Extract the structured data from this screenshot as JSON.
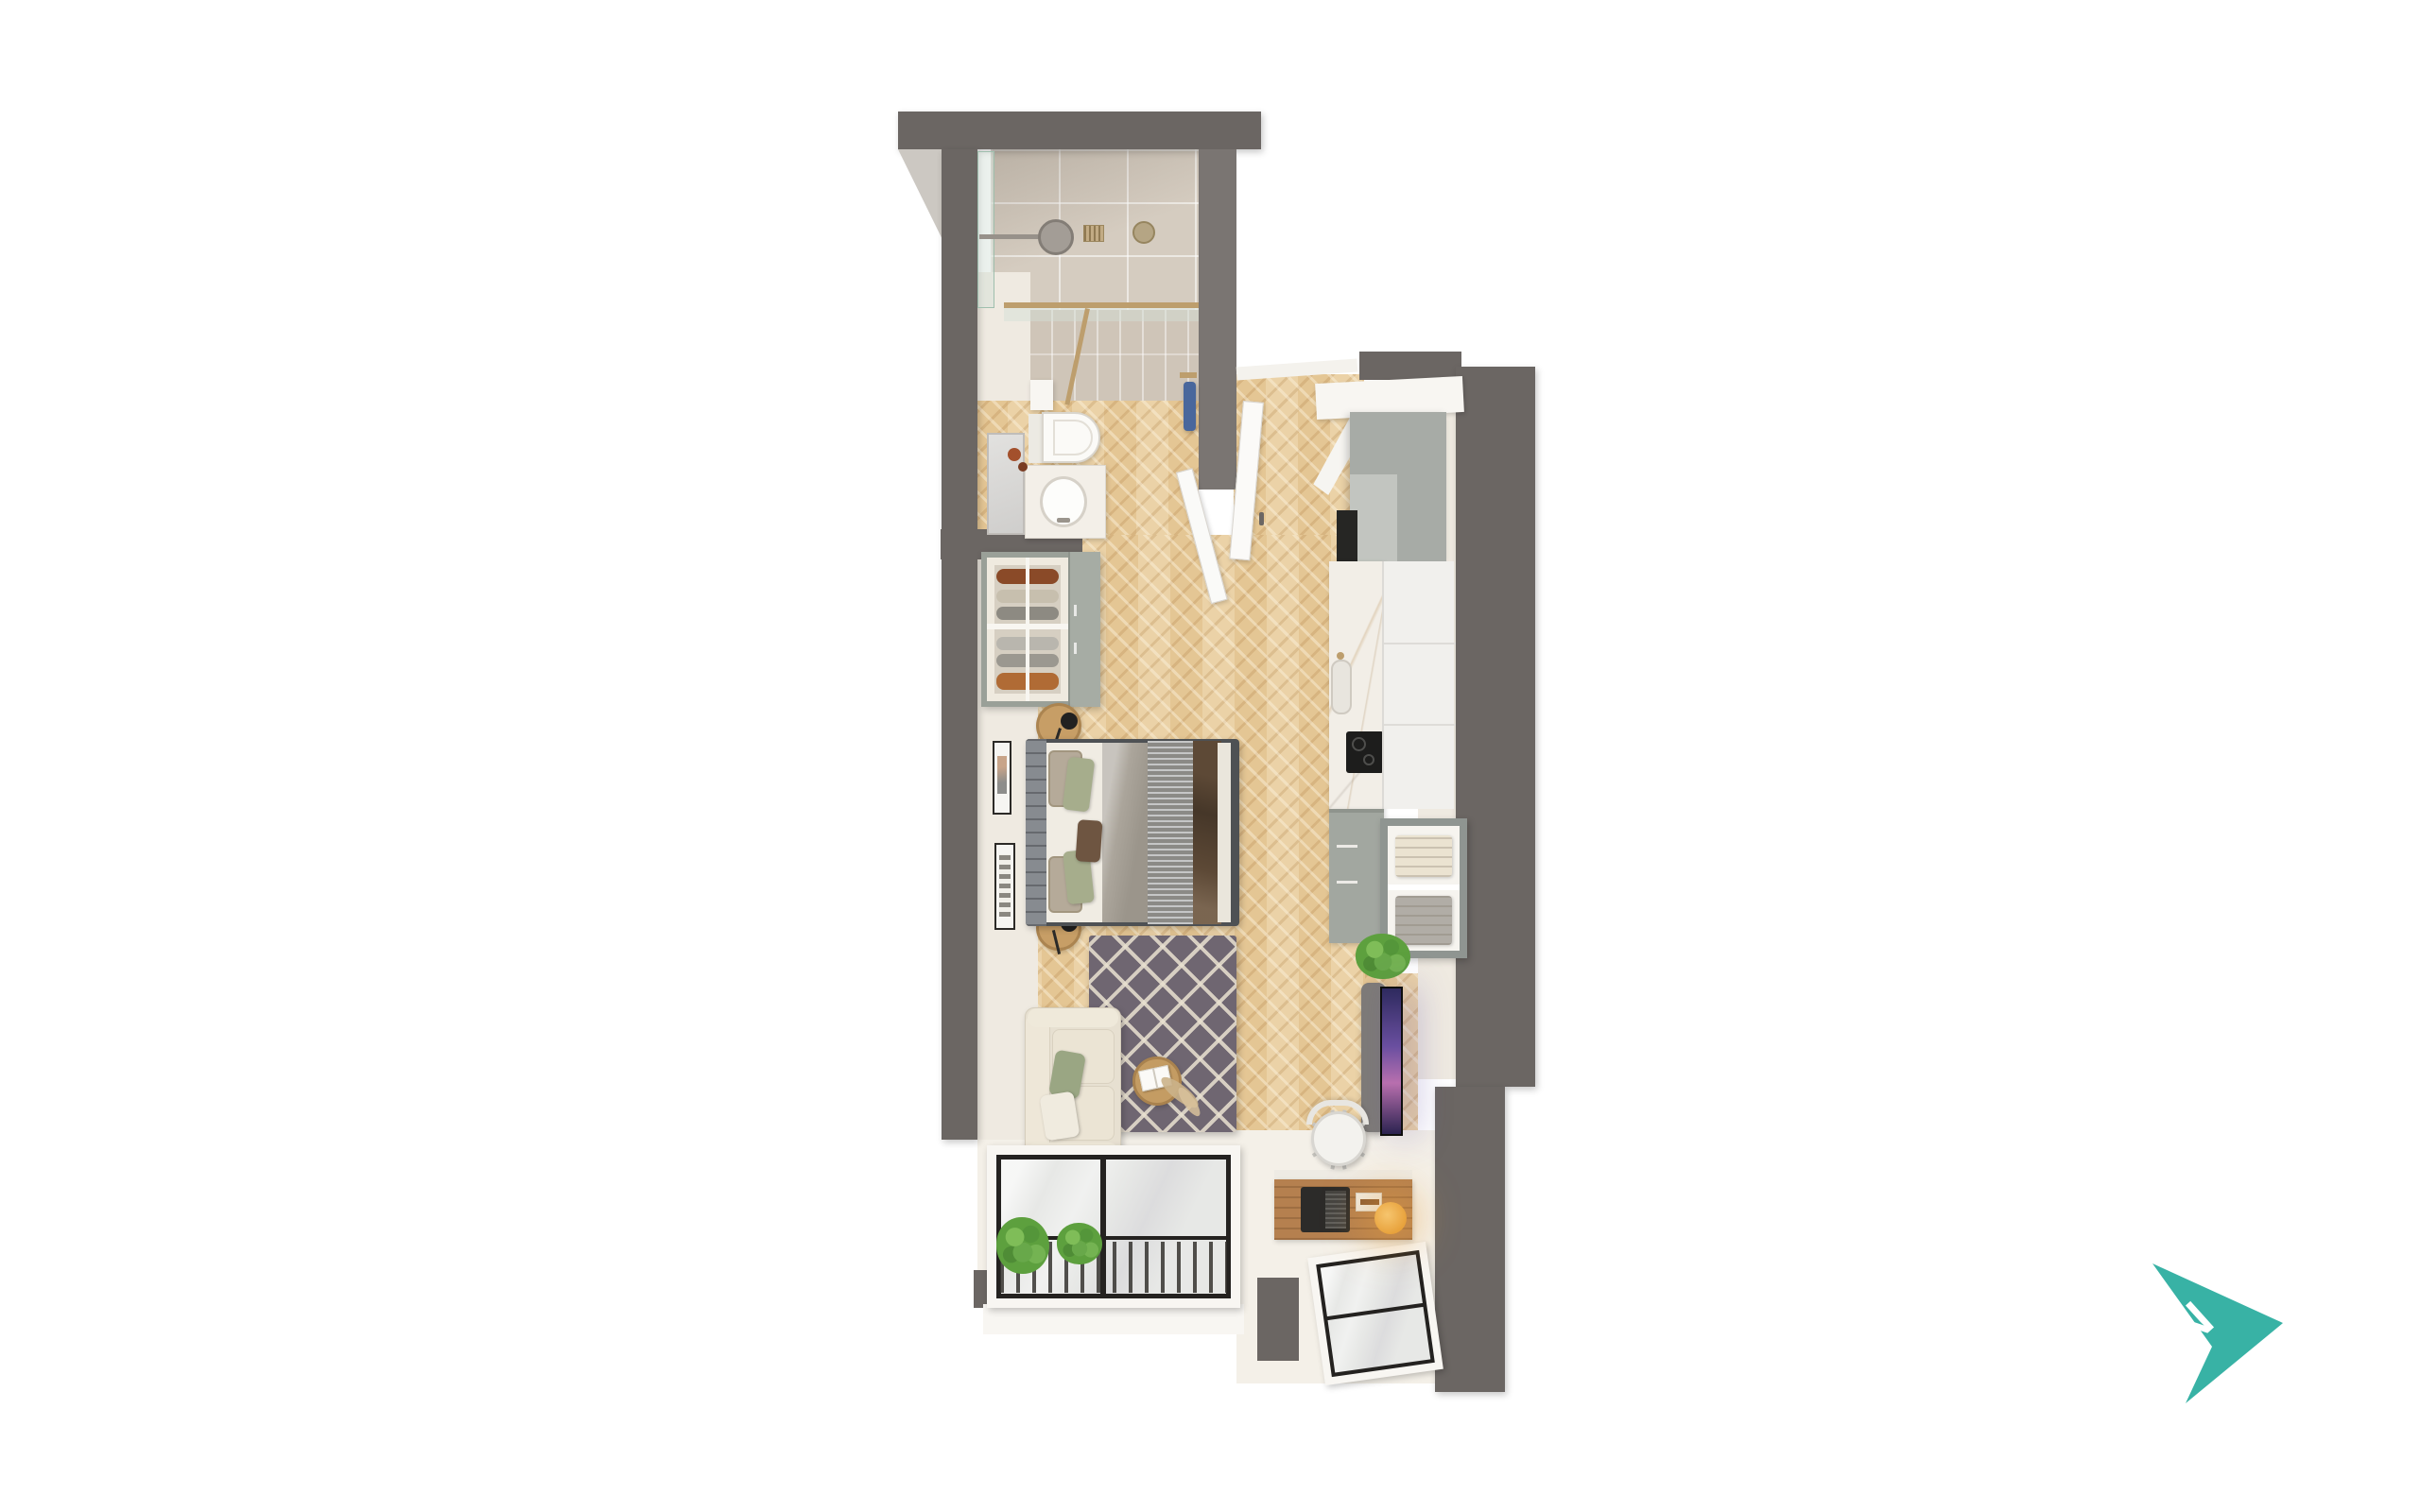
{
  "title": "Studio apartment 3D floor plan render",
  "compass": {
    "label": "N",
    "color": "#38B2A5",
    "letter_color": "#FFFFFF",
    "direction": "north-east"
  },
  "palette": {
    "background": "#FFFFFF",
    "wall": "#6B6663",
    "wall_outer_light": "#CCC8C2",
    "floor_wood": "#E9CD9D",
    "shower_tile": "#D5CCC0",
    "interior_face_cream": "#EFEAE1",
    "cabinet_sage": "#A7ABA6",
    "cabinet_white": "#F1F0ED",
    "countertop_marble": "#F2EEE7",
    "rug": "#6F6671",
    "rug_lattice": "#E9E1D0",
    "sofa": "#E7E0D1",
    "bed_linen": "#F0ECE3",
    "headboard": "#878B90",
    "throw_brown": "#5D4936",
    "pillow_sage": "#A6AD8C",
    "pillow_beige": "#B5AA99",
    "window_frame": "#242220",
    "glazing": "#E7E8E6",
    "brass": "#BD9E6D",
    "towel_blue": "#49679C",
    "desk_wood": "#B5804F",
    "lamp_glow": "#E8A23C",
    "tv_screen": "#6A4FA0",
    "plant_green": "#5DA03E"
  },
  "rooms": {
    "bathroom": {
      "items": [
        "walk-in-shower",
        "shower-head",
        "shower-arm",
        "floor-drain",
        "ceiling-valve",
        "glass-screen-brass-frame",
        "wall-hung-toilet",
        "toilet-paper-holder",
        "vanity-counter",
        "oval-basin",
        "faucet",
        "mirror",
        "amber-toiletry-bottles",
        "blue-towel-on-hook",
        "open-bathroom-door"
      ]
    },
    "entry": {
      "items": [
        "entry-door-open",
        "white-door-jamb",
        "threshold",
        "shoe-wardrobe-with-clothes"
      ]
    },
    "kitchen": {
      "items": [
        "white-bulkhead",
        "sage-upper-cabinets",
        "built-in-oven",
        "marble-countertop",
        "sink",
        "induction-hob",
        "tall-white-cabinets",
        "sage-drawer-unit",
        "open-shelf-with-folded-linen",
        "green-plant"
      ]
    },
    "living_sleeping": {
      "items": [
        "double-bed",
        "upholstered-headboard",
        "pillows",
        "gray-sheet",
        "striped-runner",
        "brown-throw",
        "round-nightstand-left",
        "round-nightstand-right",
        "black-table-lamps",
        "wall-art-frames",
        "diamond-pattern-rug",
        "round-coffee-table",
        "open-book",
        "pampas-grass",
        "cream-sofa",
        "sofa-cushions",
        "media-pedestal",
        "wall-tv",
        "wooden-desk",
        "laptop",
        "notebook",
        "glowing-desk-lamp",
        "office-chair"
      ]
    },
    "windows": {
      "items": [
        "balcony-window-wall",
        "railing-bars",
        "indoor-plants",
        "small-corner-window"
      ]
    }
  }
}
